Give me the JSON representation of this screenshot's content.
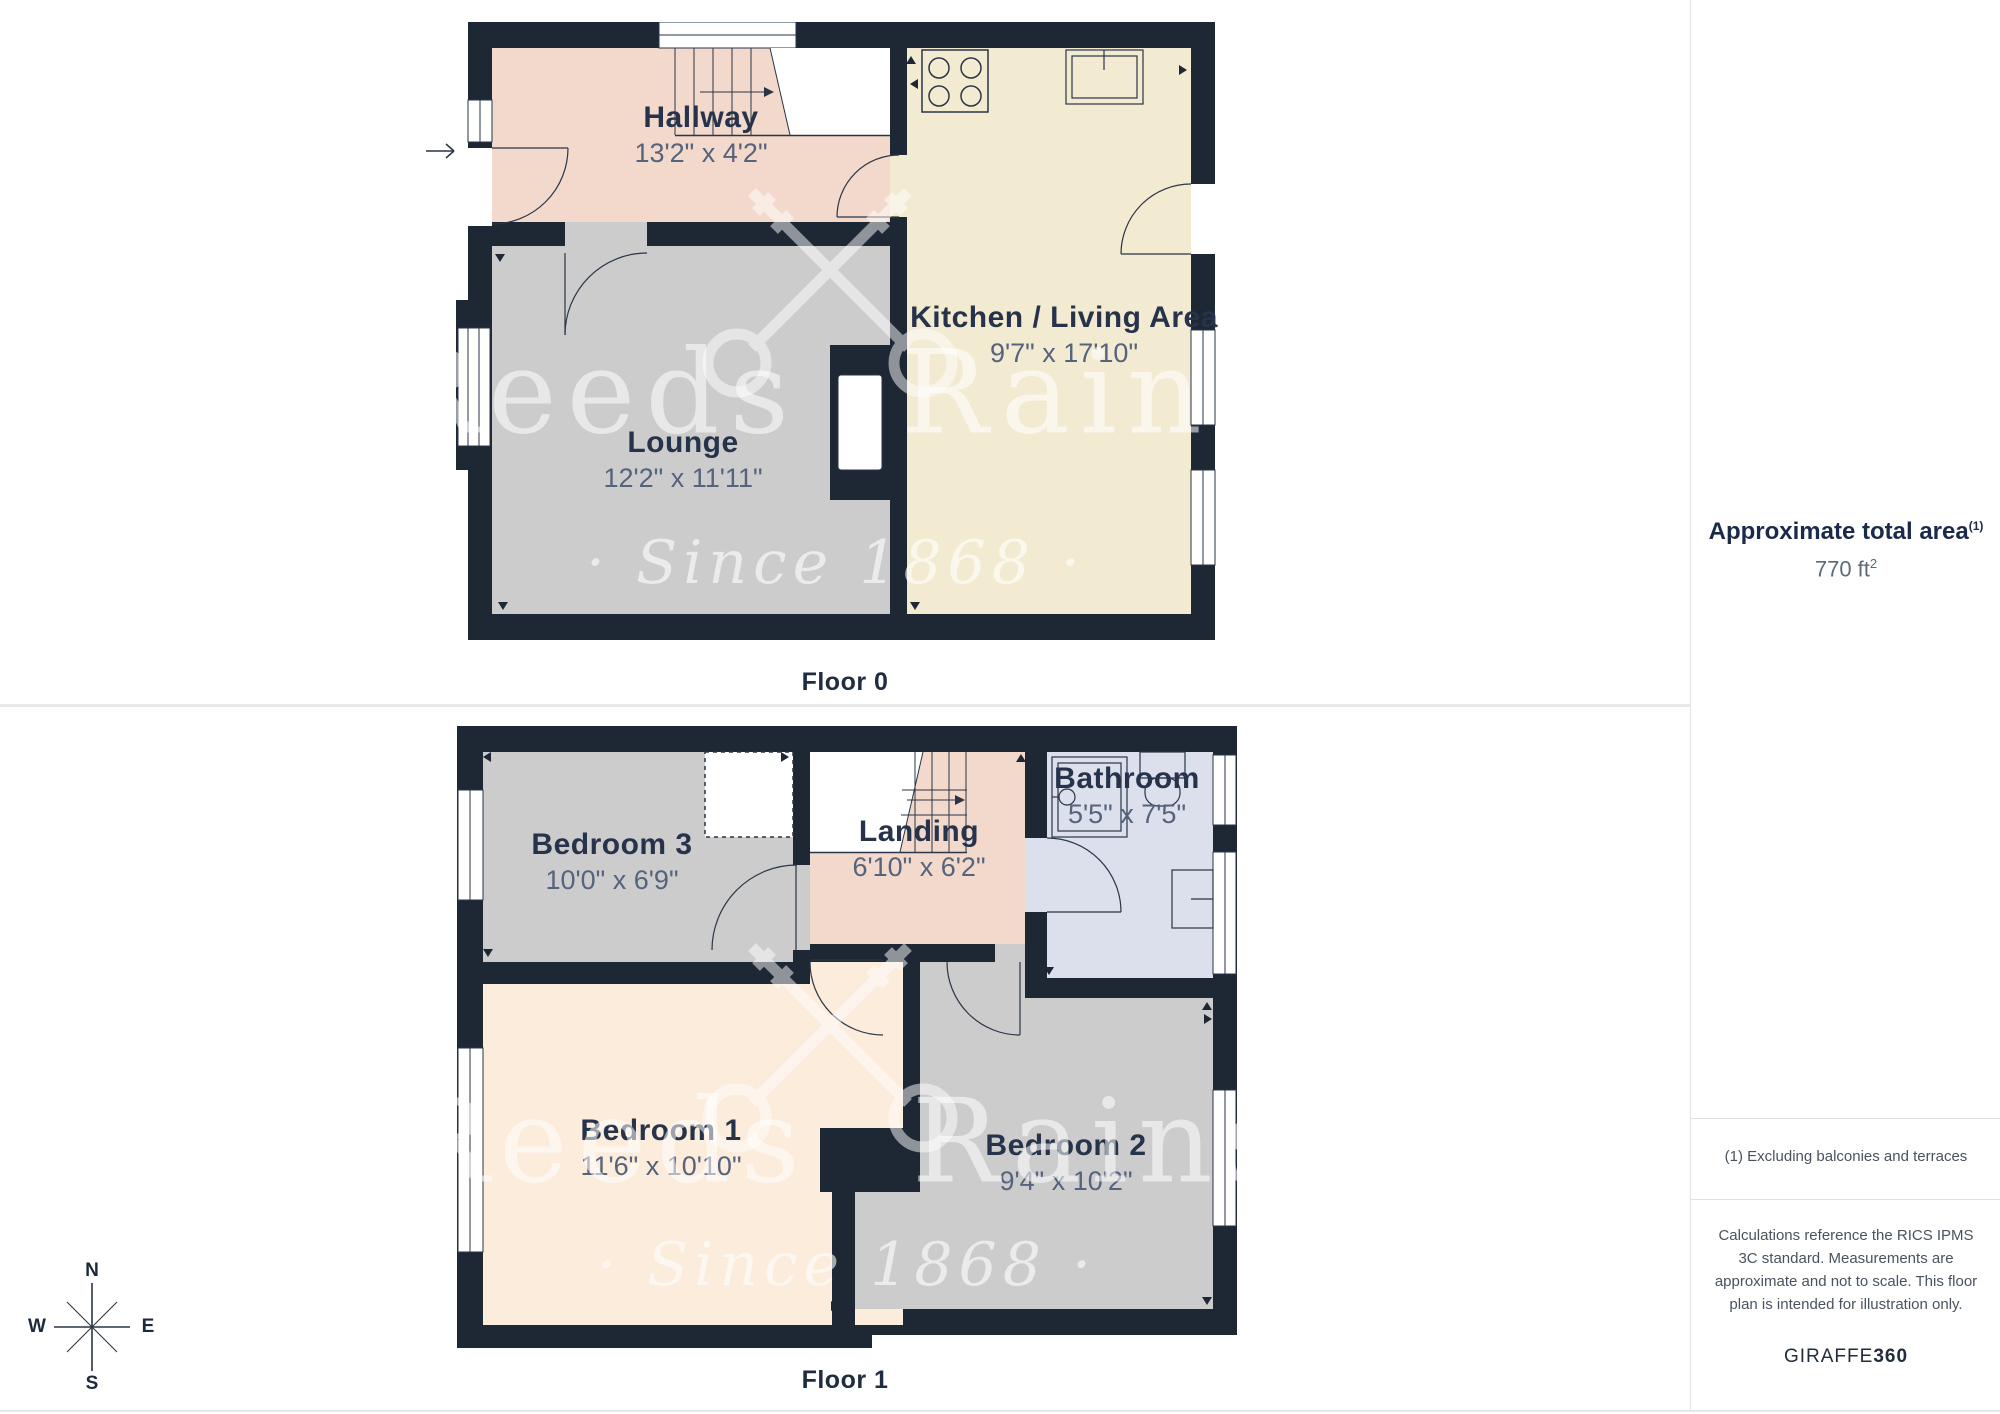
{
  "palette": {
    "wall": "#1e2734",
    "hallway_pink": "#f3d9cc",
    "kitchen_cream": "#f3ead2",
    "gray_room": "#cccccc",
    "bedroom1_peach": "#fbecdc",
    "bathroom_blue": "#dbe0ec",
    "label_dark": "#26334b",
    "dims_gray": "#55637d",
    "divider_gray": "#e8e8e8",
    "watermark_white": "rgba(255,255,255,0.55)"
  },
  "floors": [
    {
      "label": "Floor 0",
      "rooms": [
        {
          "name": "Hallway",
          "dims": "13'2\" x 4'2\""
        },
        {
          "name": "Lounge",
          "dims": "12'2\" x 11'11\""
        },
        {
          "name": "Kitchen / Living Area",
          "dims": "9'7\" x 17'10\""
        }
      ]
    },
    {
      "label": "Floor 1",
      "rooms": [
        {
          "name": "Bedroom 3",
          "dims": "10'0\" x 6'9\""
        },
        {
          "name": "Landing",
          "dims": "6'10\" x 6'2\""
        },
        {
          "name": "Bathroom",
          "dims": "5'5\" x 7'5\""
        },
        {
          "name": "Bedroom 1",
          "dims": "11'6\" x 10'10\""
        },
        {
          "name": "Bedroom 2",
          "dims": "9'4\" x 10'2\""
        }
      ]
    }
  ],
  "sidebar": {
    "title": "Approximate total area",
    "title_note": "(1)",
    "area_value": "770 ft",
    "area_sup": "2",
    "footnote": "(1) Excluding balconies and terraces",
    "disclaimer": "Calculations reference the RICS IPMS 3C standard. Measurements are approximate and not to scale. This floor plan is intended for illustration only.",
    "brand_name": "GIRAFFE",
    "brand_suffix": "360"
  },
  "watermark": {
    "name": "Reeds Rains",
    "tagline": "· Since 1868 ·"
  },
  "compass": {
    "n": "N",
    "e": "E",
    "s": "S",
    "w": "W"
  }
}
